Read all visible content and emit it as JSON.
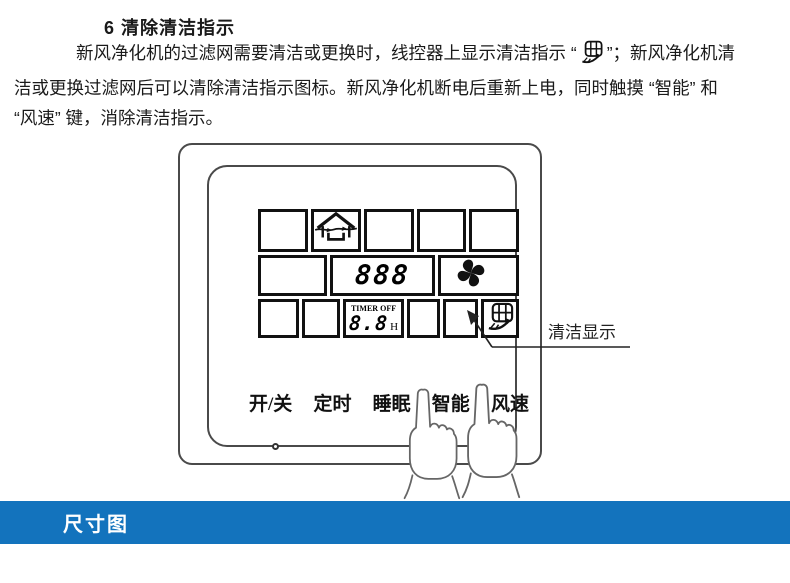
{
  "section": {
    "heading": "6  清除清洁指示",
    "para_line1_pre": "新风净化机的过滤网需要清洁或更换时，线控器上显示清洁指示 “",
    "para_line1_post": "”；新风净化机清",
    "para_line2": "洁或更换过滤网后可以清除清洁指示图标。新风净化机断电后重新上电，同时触摸 “智能” 和",
    "para_line3": "“风速” 键，消除清洁指示。"
  },
  "controller": {
    "display": {
      "number_value": "888",
      "timer_label": "TIMER",
      "timer_state": "OFF",
      "timer_value": "8.8",
      "timer_unit": "H",
      "icon_names": [
        "fresh-air-house-icon",
        "fan-icon",
        "clean-filter-icon"
      ]
    },
    "buttons": [
      {
        "label": "开/关"
      },
      {
        "label": "定时"
      },
      {
        "label": "睡眠"
      },
      {
        "label": "智能"
      },
      {
        "label": "风速"
      }
    ],
    "callout_label": "清洁显示"
  },
  "footer_banner": {
    "label": "尺寸图",
    "bg_color": "#1373bd",
    "text_color": "#ffffff"
  },
  "colors": {
    "ink": "#1a1a1a",
    "lcd_border": "#111111",
    "controller_border": "#4a4a4a"
  }
}
